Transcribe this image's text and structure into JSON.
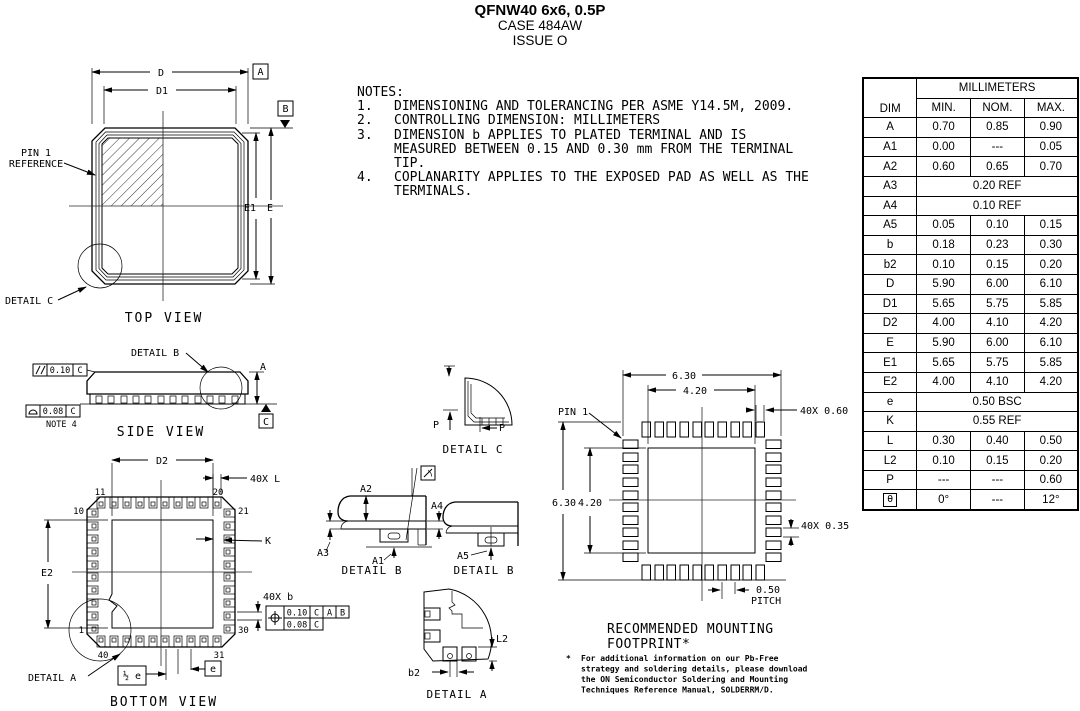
{
  "header": {
    "title": "QFNW40 6x6, 0.5P",
    "case_line": "CASE 484AW",
    "issue_line": "ISSUE O"
  },
  "notes": {
    "heading": "NOTES:",
    "items": [
      {
        "num": "1.",
        "text": "DIMENSIONING AND TOLERANCING PER ASME Y14.5M, 2009."
      },
      {
        "num": "2.",
        "text": "CONTROLLING DIMENSION: MILLIMETERS"
      },
      {
        "num": "3.",
        "text": "DIMENSION b APPLIES TO PLATED TERMINAL AND IS MEASURED BETWEEN 0.15 AND 0.30 mm FROM THE TERMINAL TIP."
      },
      {
        "num": "4.",
        "text": "COPLANARITY APPLIES TO THE EXPOSED PAD AS WELL AS THE TERMINALS."
      }
    ]
  },
  "table": {
    "unit_header": "MILLIMETERS",
    "columns": {
      "dim": "DIM",
      "min": "MIN.",
      "nom": "NOM.",
      "max": "MAX."
    },
    "rows": [
      {
        "dim": "A",
        "min": "0.70",
        "nom": "0.85",
        "max": "0.90"
      },
      {
        "dim": "A1",
        "min": "0.00",
        "nom": "---",
        "max": "0.05"
      },
      {
        "dim": "A2",
        "min": "0.60",
        "nom": "0.65",
        "max": "0.70"
      },
      {
        "dim": "A3",
        "span": "0.20 REF"
      },
      {
        "dim": "A4",
        "span": "0.10 REF"
      },
      {
        "dim": "A5",
        "min": "0.05",
        "nom": "0.10",
        "max": "0.15"
      },
      {
        "dim": "b",
        "min": "0.18",
        "nom": "0.23",
        "max": "0.30"
      },
      {
        "dim": "b2",
        "min": "0.10",
        "nom": "0.15",
        "max": "0.20"
      },
      {
        "dim": "D",
        "min": "5.90",
        "nom": "6.00",
        "max": "6.10"
      },
      {
        "dim": "D1",
        "min": "5.65",
        "nom": "5.75",
        "max": "5.85"
      },
      {
        "dim": "D2",
        "min": "4.00",
        "nom": "4.10",
        "max": "4.20"
      },
      {
        "dim": "E",
        "min": "5.90",
        "nom": "6.00",
        "max": "6.10"
      },
      {
        "dim": "E1",
        "min": "5.65",
        "nom": "5.75",
        "max": "5.85"
      },
      {
        "dim": "E2",
        "min": "4.00",
        "nom": "4.10",
        "max": "4.20"
      },
      {
        "dim": "e",
        "span": "0.50 BSC"
      },
      {
        "dim": "K",
        "span": "0.55 REF"
      },
      {
        "dim": "L",
        "min": "0.30",
        "nom": "0.40",
        "max": "0.50"
      },
      {
        "dim": "L2",
        "min": "0.10",
        "nom": "0.15",
        "max": "0.20"
      },
      {
        "dim": "P",
        "min": "---",
        "nom": "---",
        "max": "0.60"
      },
      {
        "dim": "θ",
        "min": "0°",
        "nom": "---",
        "max": "12°"
      }
    ]
  },
  "top_view": {
    "caption": "TOP VIEW",
    "dim_d": "D",
    "dim_d1": "D1",
    "dim_e1": "E1",
    "dim_e": "E",
    "datum_a": "A",
    "datum_b": "B",
    "pin1_ref_line1": "PIN 1",
    "pin1_ref_line2": "REFERENCE",
    "detail_c_callout": "DETAIL C"
  },
  "side_view": {
    "caption": "SIDE VIEW",
    "detail_b_callout": "DETAIL B",
    "dim_a": "A",
    "datum_c": "C",
    "parallelism": {
      "tol": "0.10",
      "datum": "C"
    },
    "coplanarity": {
      "tol": "0.08",
      "datum": "C"
    },
    "note_ref": "NOTE 4"
  },
  "bottom_view": {
    "caption": "BOTTOM VIEW",
    "dim_d2": "D2",
    "dim_e2": "E2",
    "qty_l": "40X L",
    "dim_k": "K",
    "qty_b": "40X b",
    "position": {
      "tol": "0.10",
      "d1": "C",
      "d2": "A",
      "d3": "B",
      "tol2": "0.08",
      "d4": "C"
    },
    "pins": {
      "p1": "1",
      "p10": "10",
      "p11": "11",
      "p20": "20",
      "p21": "21",
      "p30": "30",
      "p31": "31",
      "p40": "40"
    },
    "half_pitch": "½ e",
    "pitch": "e",
    "detail_a_callout": "DETAIL A"
  },
  "detail_c": {
    "caption": "DETAIL C",
    "p1": "P",
    "p2": "P"
  },
  "detail_b_left": {
    "caption": "DETAIL B",
    "a1": "A1",
    "a2": "A2",
    "a3": "A3",
    "a4": "A4"
  },
  "detail_b_right": {
    "caption": "DETAIL B",
    "a5": "A5"
  },
  "detail_a": {
    "caption": "DETAIL A",
    "l2": "L2",
    "b2": "b2"
  },
  "footprint": {
    "caption_line1": "RECOMMENDED MOUNTING",
    "caption_line2": "FOOTPRINT*",
    "dim_width": "6.30",
    "dim_pad_width": "4.20",
    "dim_height": "6.30",
    "dim_pad_height": "4.20",
    "qty_pad_len": "40X 0.60",
    "qty_pad_wid": "40X 0.35",
    "pin1": "PIN 1",
    "pitch_val": "0.50",
    "pitch_word": "PITCH",
    "note_star": "*",
    "note_lines": [
      "For additional information on our Pb-Free",
      "strategy and soldering details, please download",
      "the ON Semiconductor Soldering and Mounting",
      "Techniques Reference Manual, SOLDERRM/D."
    ]
  }
}
